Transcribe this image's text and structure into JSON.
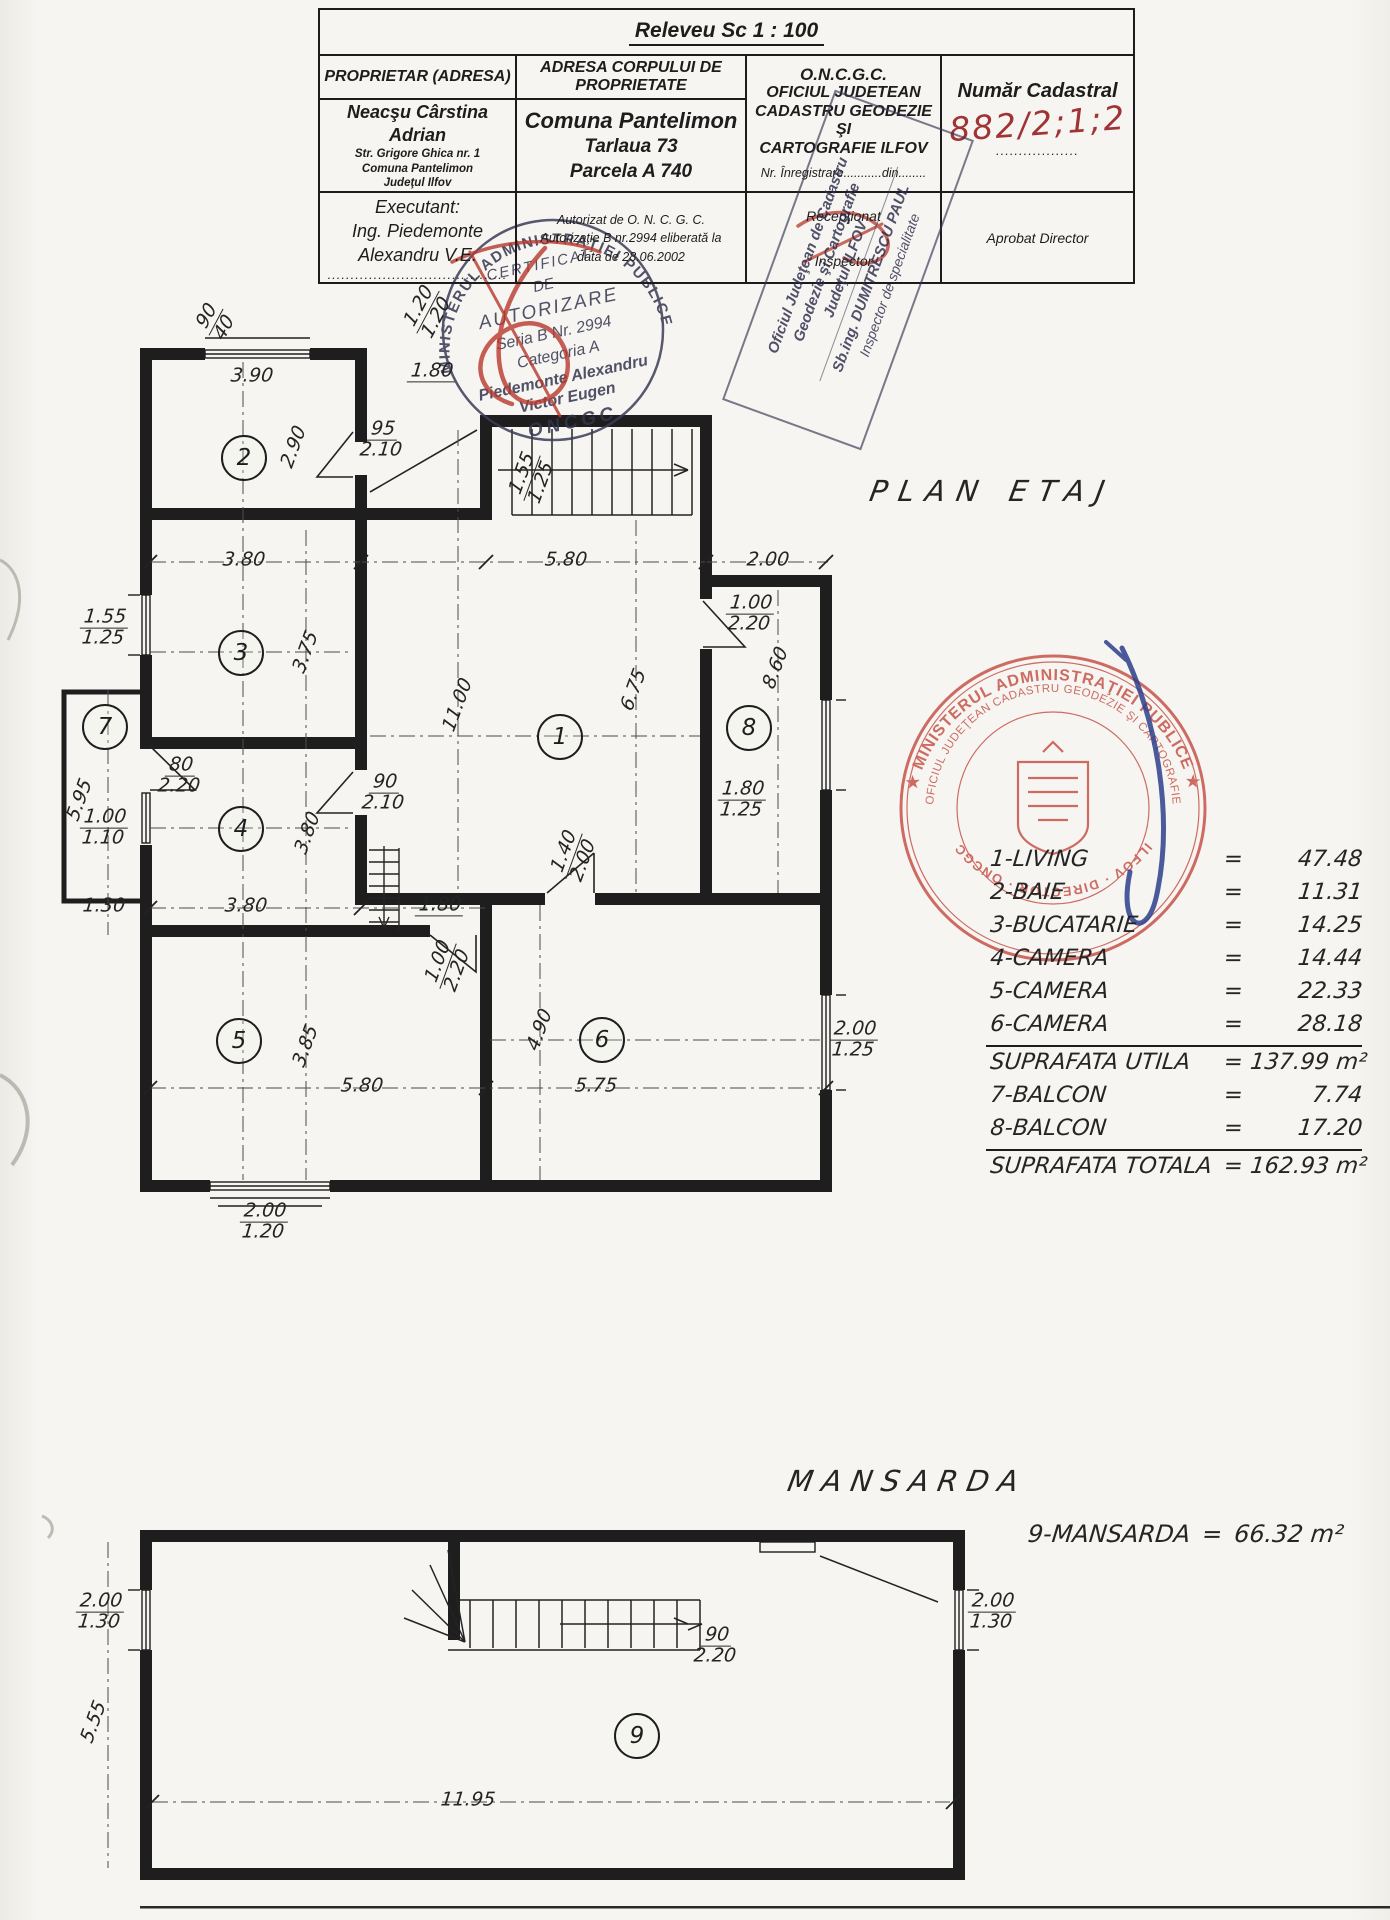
{
  "title_block": {
    "releveu": "Releveu  Sc 1 : 100",
    "col1": {
      "header": "PROPRIETAR  (ADRESA)",
      "owner_name": "Neacşu Cârstina Adrian",
      "owner_lines": [
        "Str. Grigore Ghica nr. 1",
        "Comuna Pantelimon",
        "Judeţul Ilfov"
      ],
      "executant_label": "Executant:",
      "executant_lines": [
        "Ing. Piedemonte",
        "Alexandru V.E."
      ],
      "dots": "......................................."
    },
    "col2": {
      "header_line1": "ADRESA  CORPULUI  DE",
      "header_line2": "PROPRIETATE",
      "lines": [
        "Comuna Pantelimon",
        "Tarlaua 73",
        "Parcela A 740"
      ],
      "auth_lines": [
        "Autorizat de  O. N. C. G. C.",
        "Autorizaţie B nr.2994  eliberată la",
        "data de 28.06.2002"
      ]
    },
    "col3": {
      "lines": [
        "O.N.C.G.C.",
        "OFICIUL  JUDETEAN",
        "CADASTRU  GEODEZIE ŞI",
        "CARTOGRAFIE  ILFOV"
      ],
      "registration": "Nr. Înregistrare...........din........",
      "receptionat": "Recepţionat",
      "inspector": "Inspector"
    },
    "col4": {
      "header": "Număr Cadastral",
      "number": "882/2;1;2",
      "dots": "..................",
      "approved": "Aprobat Director"
    }
  },
  "stamps": {
    "certificate": {
      "ring": "MINISTERUL  ADMINISTRAŢIEI  PUBLICE",
      "lines": [
        "CERTIFICAT",
        "DE",
        "AUTORIZARE",
        "Seria B  Nr. 2994",
        "Categoria A",
        "Piedemonte Alexandru",
        "Victor Eugen"
      ],
      "bottom": "ONCGC"
    },
    "office": {
      "lines": [
        "Oficiul Judeţean de Cadastru",
        "Geodezie şi Cartografie",
        "Judeţul ILFOV",
        "Sb.ing. DUMITRESCU PAUL",
        "Inspector de specialitate"
      ]
    },
    "round_red": {
      "outer": "★ MINISTERUL  ADMINISTRAŢIEI  PUBLICE ★",
      "inner": "OFICIUL JUDEŢEAN CADASTRU GEODEZIE ŞI CARTOGRAFIE",
      "bottom": "ILFOV · DIRECTOR · ONCGC"
    }
  },
  "plan_etaj": {
    "title": "PLAN ETAJ",
    "rooms": [
      {
        "n": "1",
        "x": 559,
        "y": 736
      },
      {
        "n": "2",
        "x": 243,
        "y": 457
      },
      {
        "n": "3",
        "x": 240,
        "y": 652
      },
      {
        "n": "4",
        "x": 240,
        "y": 828
      },
      {
        "n": "5",
        "x": 238,
        "y": 1040
      },
      {
        "n": "6",
        "x": 601,
        "y": 1039
      },
      {
        "n": "7",
        "x": 104,
        "y": 726
      },
      {
        "n": "8",
        "x": 748,
        "y": 727
      }
    ],
    "dimensions": [
      {
        "a": "90",
        "b": "40",
        "x": 216,
        "y": 322,
        "rot": -62
      },
      {
        "a": "3.90",
        "x": 252,
        "y": 376
      },
      {
        "a": "1.20",
        "b": "1.20",
        "x": 428,
        "y": 312,
        "rot": -62
      },
      {
        "a": "1.80",
        "x": 432,
        "y": 372,
        "u": true
      },
      {
        "a": "95",
        "b": "2.10",
        "x": 382,
        "y": 440
      },
      {
        "a": "2.90",
        "x": 294,
        "y": 447,
        "rot": -70
      },
      {
        "a": "1.55",
        "b": "1.25",
        "x": 532,
        "y": 478,
        "rot": -70
      },
      {
        "a": "5.80",
        "x": 566,
        "y": 560
      },
      {
        "a": "2.00",
        "x": 768,
        "y": 560
      },
      {
        "a": "3.80",
        "x": 244,
        "y": 560
      },
      {
        "a": "1.55",
        "b": "1.25",
        "x": 104,
        "y": 628
      },
      {
        "a": "3.75",
        "x": 306,
        "y": 652,
        "rot": -70
      },
      {
        "a": "11.00",
        "x": 458,
        "y": 705,
        "rot": -70
      },
      {
        "a": "6.75",
        "x": 634,
        "y": 690,
        "rot": -70
      },
      {
        "a": "8.60",
        "x": 776,
        "y": 668,
        "rot": -70
      },
      {
        "a": "1.00",
        "b": "2.20",
        "x": 750,
        "y": 614
      },
      {
        "a": "1.80",
        "b": "1.25",
        "x": 742,
        "y": 800
      },
      {
        "a": "5.95",
        "x": 80,
        "y": 800,
        "rot": -70
      },
      {
        "a": "80",
        "b": "2.20",
        "x": 180,
        "y": 776
      },
      {
        "a": "1.00",
        "b": "1.10",
        "x": 104,
        "y": 828
      },
      {
        "a": "90",
        "b": "2.10",
        "x": 384,
        "y": 793
      },
      {
        "a": "3.80",
        "x": 308,
        "y": 833,
        "rot": -70
      },
      {
        "a": "1.30",
        "x": 104,
        "y": 906
      },
      {
        "a": "3.80",
        "x": 246,
        "y": 906
      },
      {
        "a": "1.80",
        "x": 440,
        "y": 906,
        "u": true
      },
      {
        "a": "1.40",
        "b": "2.00",
        "x": 574,
        "y": 856,
        "rot": -70
      },
      {
        "a": "1.00",
        "b": "2.20",
        "x": 448,
        "y": 966,
        "rot": -70
      },
      {
        "a": "3.85",
        "x": 306,
        "y": 1046,
        "rot": -70
      },
      {
        "a": "4.90",
        "x": 540,
        "y": 1030,
        "rot": -70
      },
      {
        "a": "5.80",
        "x": 362,
        "y": 1086
      },
      {
        "a": "5.75",
        "x": 596,
        "y": 1086
      },
      {
        "a": "2.00",
        "b": "1.25",
        "x": 854,
        "y": 1040
      },
      {
        "a": "2.00",
        "b": "1.20",
        "x": 264,
        "y": 1222
      }
    ]
  },
  "plan_mansarda": {
    "title": "MANSARDA",
    "note_label": "9-MANSARDA",
    "note_eq": "=",
    "note_value": "66.32 m²",
    "rooms": [
      {
        "n": "9",
        "x": 636,
        "y": 1735
      }
    ],
    "dimensions": [
      {
        "a": "2.00",
        "b": "1.30",
        "x": 100,
        "y": 1612
      },
      {
        "a": "2.00",
        "b": "1.30",
        "x": 992,
        "y": 1612
      },
      {
        "a": "90",
        "b": "2.20",
        "x": 716,
        "y": 1646
      },
      {
        "a": "5.55",
        "x": 94,
        "y": 1722,
        "rot": -70
      },
      {
        "a": "11.95",
        "x": 468,
        "y": 1800
      }
    ]
  },
  "legend": {
    "equals_sign": "=",
    "rows": [
      {
        "label": "1-LIVING",
        "value": "47.48"
      },
      {
        "label": "2-BAIE",
        "value": "11.31"
      },
      {
        "label": "3-BUCATARIE",
        "value": "14.25"
      },
      {
        "label": "4-CAMERA",
        "value": "14.44"
      },
      {
        "label": "5-CAMERA",
        "value": "22.33"
      },
      {
        "label": "6-CAMERA",
        "value": "28.18",
        "rule_after": true
      },
      {
        "label": "SUPRAFATA UTILA",
        "value": "137.99 m²"
      },
      {
        "label": "7-BALCON",
        "value": "7.74"
      },
      {
        "label": "8-BALCON",
        "value": "17.20",
        "rule_after": true
      },
      {
        "label": "SUPRAFATA TOTALA",
        "value": "162.93 m²"
      }
    ]
  }
}
